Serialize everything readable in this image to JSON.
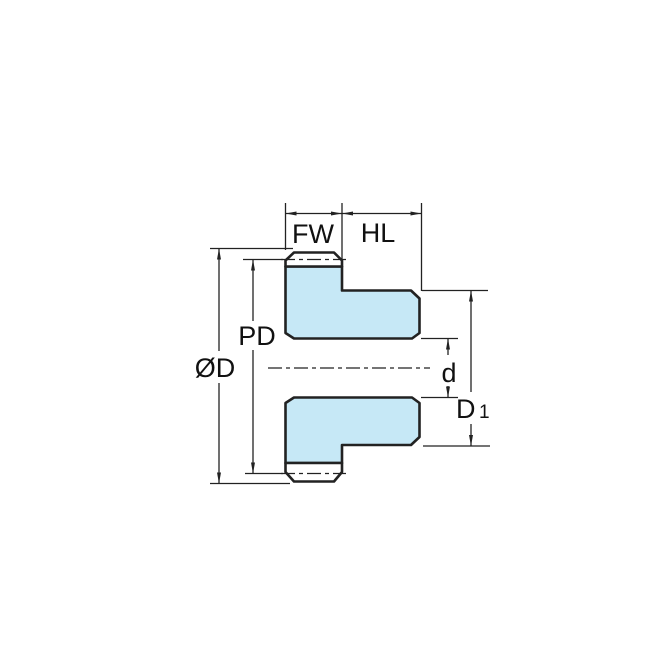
{
  "diagram": {
    "type": "technical-drawing",
    "labels": {
      "face_width": "FW",
      "hub_length": "HL",
      "pitch_diameter": "PD",
      "outside_diameter": "ØD",
      "bore_diameter": "d",
      "hub_diameter_main": "D",
      "hub_diameter_sub": "1"
    },
    "colors": {
      "gear_fill": "#c6e8f6",
      "tooth_fill": "#ffffff",
      "line": "#222222",
      "text": "#111111",
      "background": "#ffffff"
    }
  }
}
